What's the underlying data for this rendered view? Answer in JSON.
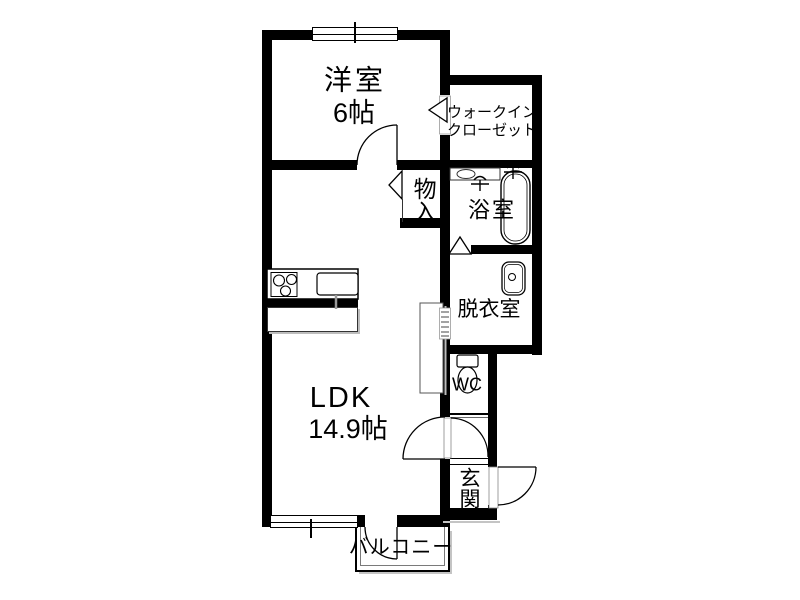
{
  "floorplan": {
    "rooms": {
      "yoshitsu": {
        "name": "洋室",
        "size": "6帖"
      },
      "wic": {
        "line1": "ウォークイン",
        "line2": "クローゼット"
      },
      "mononoire": {
        "name": "物入"
      },
      "yokushitsu": {
        "name": "浴室"
      },
      "datsuishitsu": {
        "name": "脱衣室"
      },
      "ldk": {
        "name": "LDK",
        "size": "14.9帖"
      },
      "wc": {
        "name": "WC"
      },
      "genkan": {
        "name": "玄関"
      },
      "balcony": {
        "name": "バルコニー"
      }
    },
    "fixtures": [
      "bathtub",
      "shower-faucet",
      "bath-counter-basin",
      "washbasin",
      "toilet",
      "stove-burners",
      "kitchen-sink",
      "kitchen-island",
      "side-counter"
    ],
    "colors": {
      "wall": "#000000",
      "background": "#ffffff",
      "fixture_line": "#1a1a1a",
      "shadow": "#c4c4c4"
    }
  }
}
